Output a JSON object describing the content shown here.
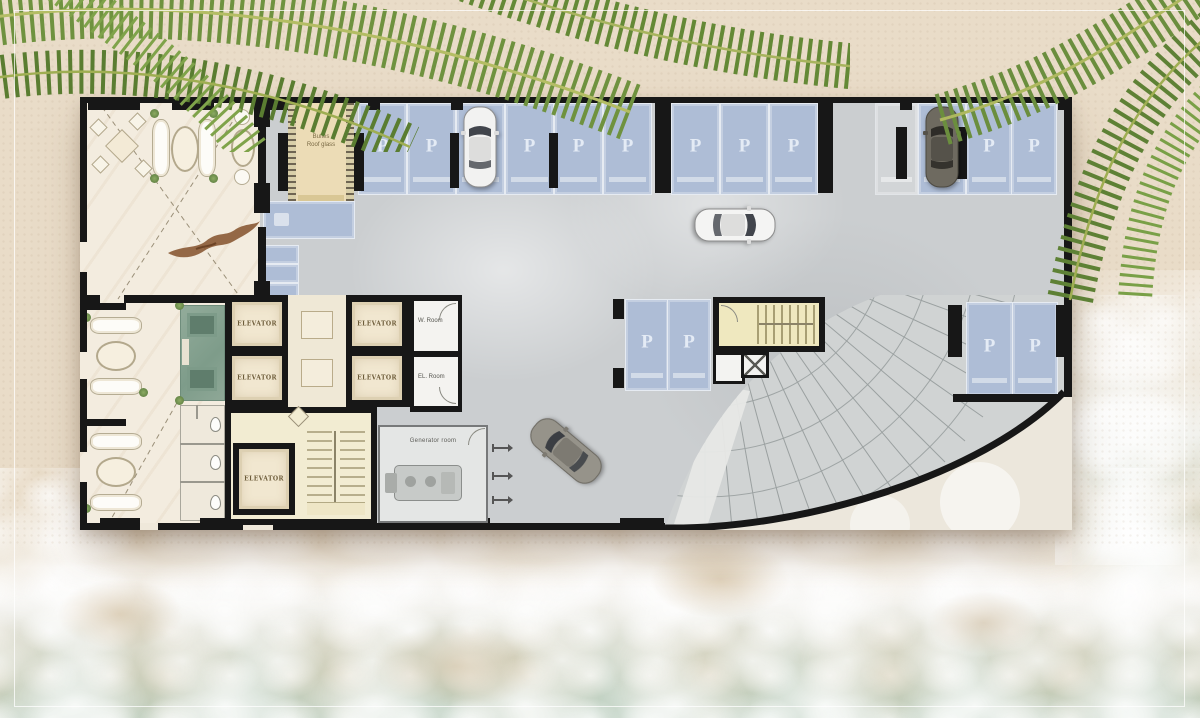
{
  "scene": {
    "frame_color": "#ffffff"
  },
  "plan": {
    "elevator_label": "ELEVATOR",
    "ramp": {
      "line1": "Bufles",
      "line2": "Roof glass"
    },
    "generator_label": "Generator room",
    "rooms": {
      "top": "W. Room",
      "bottom": "EL. Room"
    },
    "parking": {
      "stall_label": "P"
    },
    "colors": {
      "wall": "#171717",
      "stall_blue": "#aebdd6",
      "concrete": "#cbced0",
      "lobby_marble": "#f3ecdf",
      "elevator_cream": "#f1e7d0",
      "stair_yellow": "#efe8bf",
      "reception_green": "#8da796"
    }
  },
  "beach": {
    "colors": {
      "sand": "#e9dcc8",
      "foam": "#f4f1ea",
      "sea": "#b2c8b9",
      "palm": "#6b8e3e"
    }
  }
}
